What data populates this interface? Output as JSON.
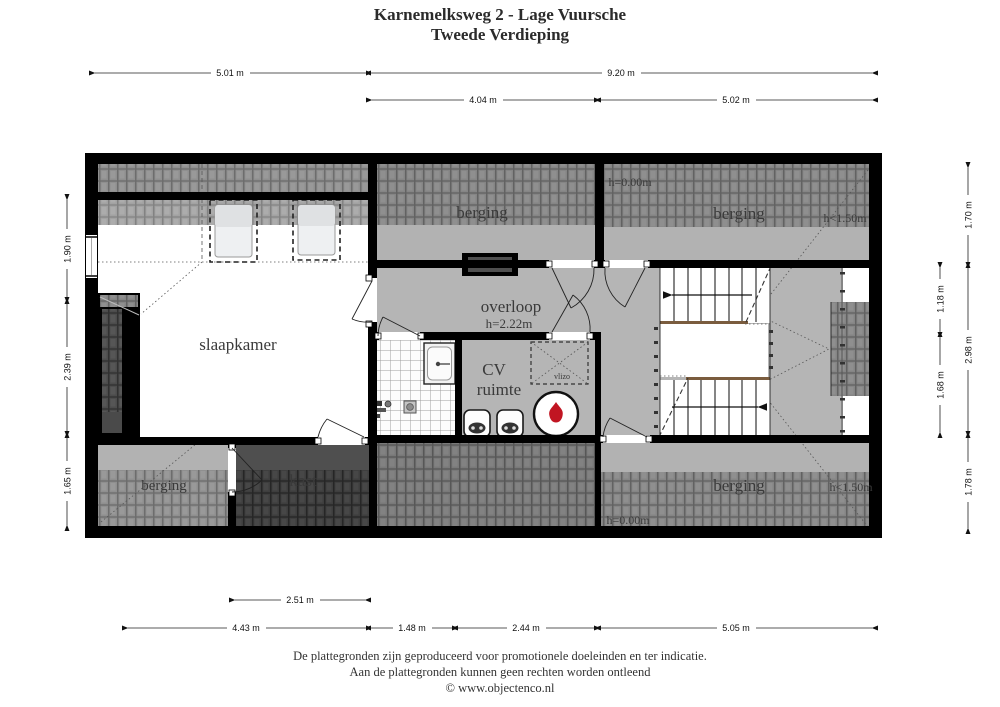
{
  "title": {
    "line1": "Karnemelksweg 2 - Lage Vuursche",
    "line2": "Tweede Verdieping"
  },
  "rooms": {
    "slaapkamer": "slaapkamer",
    "berging_top": "berging",
    "berging_top_right": "berging",
    "berging_bottom_left": "berging",
    "berging_bottom_right": "berging",
    "kast": "kast",
    "overloop": "overloop",
    "overloop_height": "h=2.22m",
    "cv_line1": "CV",
    "cv_line2": "ruimte",
    "vlizo": "vlizo"
  },
  "height_labels": {
    "top_h000": "h=0.00m",
    "top_h150": "h<1.50m",
    "bottom_h000": "h=0.00m",
    "bottom_h150": "h<1.50m"
  },
  "dimensions": {
    "top_row1": [
      {
        "label": "5.01 m"
      },
      {
        "label": "9.20 m"
      }
    ],
    "top_row2": [
      {
        "label": "4.04 m"
      },
      {
        "label": "5.02 m"
      }
    ],
    "bottom_row1": [
      {
        "label": "2.51 m"
      }
    ],
    "bottom_row2": [
      {
        "label": "4.43 m"
      },
      {
        "label": "1.48 m"
      },
      {
        "label": "2.44 m"
      },
      {
        "label": "5.05 m"
      }
    ],
    "left": [
      {
        "label": "1.90 m"
      },
      {
        "label": "2.39 m"
      },
      {
        "label": "1.65 m"
      }
    ],
    "right_inner": [
      {
        "label": "1.18 m"
      },
      {
        "label": "1.68 m"
      }
    ],
    "right_outer": [
      {
        "label": "1.70 m"
      },
      {
        "label": "2.98 m"
      },
      {
        "label": "1.78 m"
      }
    ]
  },
  "footer": {
    "line1": "De plattegronden zijn geproduceerd voor promotionele doeleinden en ter indicatie.",
    "line2": "Aan de plattegronden kunnen geen rechten worden ontleend",
    "line3": "© www.objectenco.nl"
  },
  "colors": {
    "wall": "#000000",
    "floor_grey": "#b4b4b4",
    "flame_red": "#c11522"
  }
}
